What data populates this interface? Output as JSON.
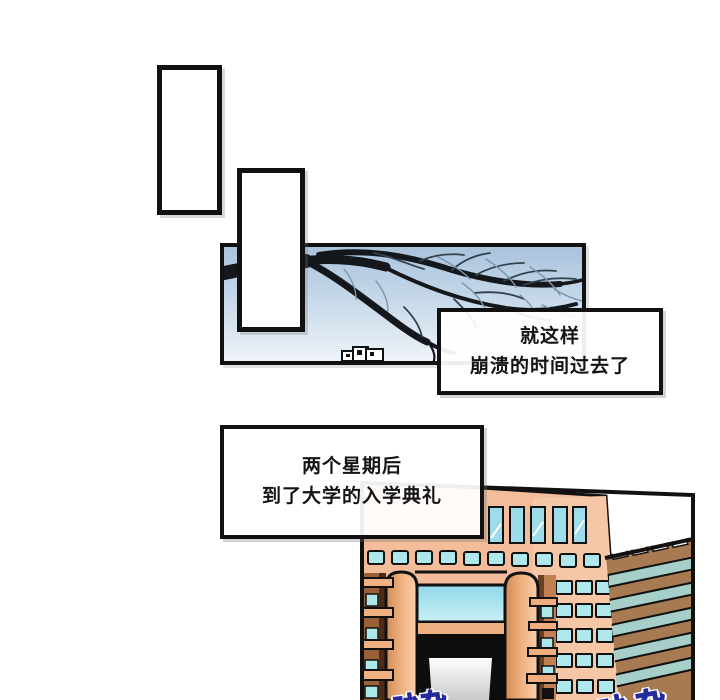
{
  "page": {
    "width": 720,
    "height": 700,
    "background": "#ffffff"
  },
  "narration": {
    "box1": {
      "line1": "就这样",
      "line2": "崩溃的时间过去了"
    },
    "box2": {
      "line1": "两个星期后",
      "line2": "到了大学的入学典礼"
    }
  },
  "sfx": {
    "left": "吵杂",
    "right": "吵杂",
    "text_color": "#4553e0",
    "outline_color": "#242b9e"
  },
  "colors": {
    "panel_border": "#111111",
    "sky_top": "#a9c3dc",
    "sky_bottom": "#eef3f8",
    "branch_black": "#14171c",
    "twig_blue": "#5f7a94",
    "building_face": "#f3bd9b",
    "building_face_light": "#f7c9a9",
    "window_teal": "#a5e2ea",
    "tall_window_teal": "#9edcec",
    "pillar_dark": "#d28c56",
    "pillar_light": "#f8cfae",
    "ledge_orange": "#f2b183",
    "wing_wall": "#9a6038",
    "beam_orange": "#edaf7f",
    "side_building_brown": "#a87a52",
    "side_building_band": "#a6cfc9",
    "entrance_black": "#0d0d0d"
  }
}
